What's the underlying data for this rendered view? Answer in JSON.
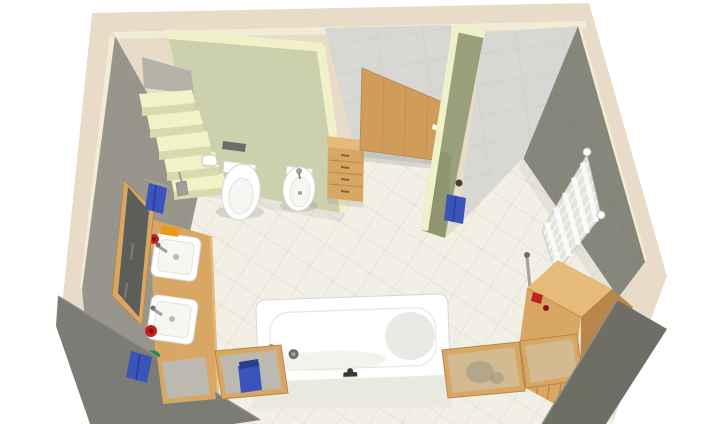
{
  "meta": {
    "kind": "3D bathroom floor-plan render",
    "view": "elevated isometric cutaway",
    "canvas_width": 720,
    "canvas_height": 424
  },
  "palette": {
    "canvas": "#ffffff",
    "wall_top_band": "#e8dcc8",
    "wall_top_face": "#f1ecd6",
    "cut_wall_left": "#7c7c76",
    "cut_wall_right": "#6e6e67",
    "left_wall": "#98958c",
    "left_wall_seam": "#8b8880",
    "green_wall": "#cdd0ac",
    "green_wall_cream": "#f1f1c9",
    "partition_face": "#9aa07b",
    "partition_shadow": "#868c66",
    "back_wall": "#d7d7d4",
    "back_wall_seam": "#c5c5c1",
    "right_wall": "#87867b",
    "right_wall_seam": "#79786d",
    "floor": "#f2f0e5",
    "floor_seam": "#e1decf",
    "stair_top": "#f2f2c9",
    "stair_front": "#d9daab",
    "stair_landing": "#b4b1a8",
    "wood": "#d8a763",
    "wood_light": "#e6ba79",
    "wood_dark": "#b8854b",
    "door_wood": "#cf9d59",
    "door_grain": "#b9854a",
    "fixture_white": "#ffffff",
    "fixture_line": "#d7d7d3",
    "fixture_inner": "#f6f6f3",
    "fixture_shade": "#e9e9e5",
    "chrome": "#a0a09c",
    "chrome_dark": "#6f6f68",
    "towel_blue": "#3a54bb",
    "towel_blue_dark": "#2b3e93",
    "accent_red": "#c32020",
    "accent_red_dark": "#8c1212",
    "accent_orange": "#e89a1e",
    "accent_green": "#218a4b",
    "radiator_body": "#e3e3df",
    "radiator_bar": "#fafaf8",
    "radiator_line": "#c9c9c4",
    "glass_gray": "#b9bdb8",
    "glass_clear": "#ced2c9",
    "mirror_glass": "#5d5d59",
    "vent": "#6e6e68",
    "shadow": "#8e8e86",
    "tub_apron": "#e9e9e0",
    "faucet_black": "#3a3a32"
  },
  "scene": {
    "room": "bathroom",
    "objects": [
      {
        "name": "staircase",
        "label": "Open staircase (5 steps)",
        "color_key": "stair_top"
      },
      {
        "name": "toilet",
        "label": "Wall-hung toilet",
        "color_key": "fixture_white"
      },
      {
        "name": "bidet",
        "label": "Bidet",
        "color_key": "fixture_white"
      },
      {
        "name": "toilet-paper-holder",
        "label": "Toilet paper holder",
        "color_key": "fixture_white"
      },
      {
        "name": "toilet-brush",
        "label": "Toilet brush",
        "color_key": "chrome"
      },
      {
        "name": "wall-vent",
        "label": "Wall vent / flush plate",
        "color_key": "vent"
      },
      {
        "name": "drawer-cabinet",
        "label": "Wooden drawer cabinet",
        "color_key": "wood"
      },
      {
        "name": "door",
        "label": "Wooden door with white handle",
        "color_key": "door_wood"
      },
      {
        "name": "partition-wall",
        "label": "Green partition wall",
        "color_key": "partition_face"
      },
      {
        "name": "towel-on-hook",
        "label": "Blue towel on hook",
        "color_key": "towel_blue"
      },
      {
        "name": "towel-radiator",
        "label": "Ladder towel radiator",
        "color_key": "radiator_body"
      },
      {
        "name": "corner-cabinet",
        "label": "Wooden corner cabinet",
        "color_key": "wood"
      },
      {
        "name": "washbasin-counter",
        "label": "Wooden washbasin counter",
        "color_key": "wood"
      },
      {
        "name": "washbasin-1",
        "label": "Washbasin (upper)",
        "color_key": "fixture_white"
      },
      {
        "name": "washbasin-2",
        "label": "Washbasin (lower)",
        "color_key": "fixture_white"
      },
      {
        "name": "soap-dispenser-red",
        "label": "Red soap dispensers",
        "color_key": "accent_red"
      },
      {
        "name": "soap-dish-orange",
        "label": "Orange soap dish",
        "color_key": "accent_orange"
      },
      {
        "name": "soap-green",
        "label": "Green soap",
        "color_key": "accent_green"
      },
      {
        "name": "wall-mirror",
        "label": "Framed wall mirror",
        "color_key": "mirror_glass"
      },
      {
        "name": "towel-rail",
        "label": "Towel rail with blue towels",
        "color_key": "towel_blue"
      },
      {
        "name": "bathtub",
        "label": "Bathtub with black faucet",
        "color_key": "fixture_white"
      },
      {
        "name": "glass-panel",
        "label": "Wood-framed glass panels (4)",
        "color_key": "glass_gray"
      }
    ]
  }
}
